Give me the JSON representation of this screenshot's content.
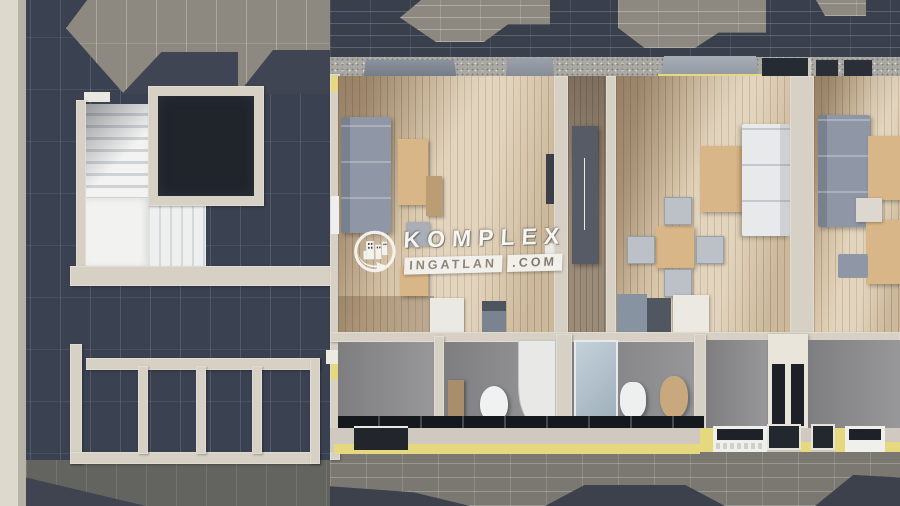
{
  "meta": {
    "kind": "3d-architectural-floor-plan-render",
    "description": "Top-down 3D render of an attic storey: stairwell with lift shaft on the left, two furnished studio apartments with bathrooms in the middle, a third apartment partially visible at the right edge, surrounded by dark tiled roof planes"
  },
  "watermark": {
    "logo_icon": "komplex-buildings-arrow-icon",
    "brand": "KOMPLEX",
    "site_name": "INGATLAN",
    "site_tld": ".COM"
  },
  "palette": {
    "roof_dark": "#3a4150",
    "roof_brick_top": "#39404c",
    "roof_lit": "#8d8880",
    "roof_bottom": "#7b7872",
    "wall_beige": "#d7d1c5",
    "wall_concrete": "#a9a8a3",
    "floor_wood": "#d7c5a9",
    "floor_wood_dark": "#9b8c7a",
    "insulation_yellow": "#e6d87e",
    "sofa_gray": "#8f97a6",
    "sofa_white": "#e8e9eb",
    "furniture_tan": "#d9b687",
    "wardrobe_dark": "#565b65",
    "bathroom_floor": "#98989a",
    "shaft_dark": "#20242b",
    "stairs_white": "#f2f3f1",
    "watermark_white": "#f3f2ee"
  }
}
